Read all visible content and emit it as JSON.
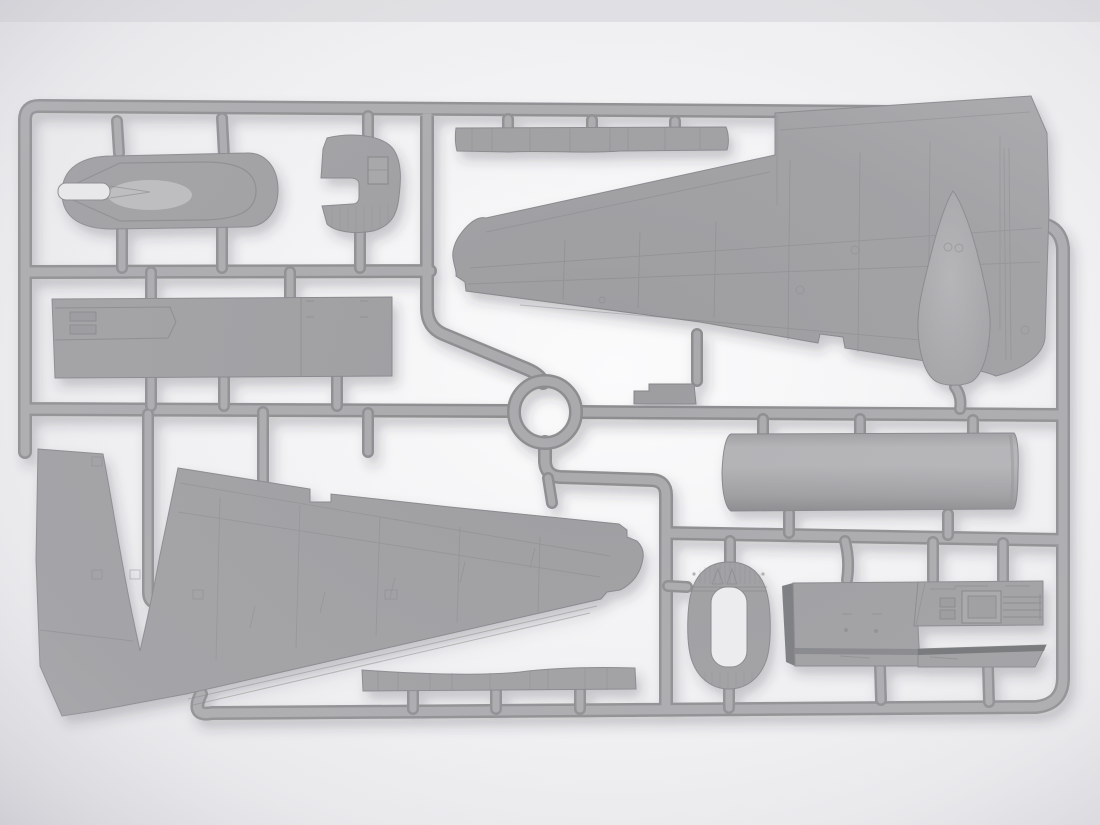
{
  "scene": {
    "subject": "gray injection-molded plastic model kit sprue photographed on a light background",
    "canvas": {
      "width": 1100,
      "height": 825
    }
  },
  "colors": {
    "bg_corner": "#e0e0e4",
    "bg_mid": "#f0f0f2",
    "bg_center": "#fbfbfc",
    "plastic": "#9d9da0",
    "plastic_light": "#b2b2b5",
    "plastic_lighter": "#c0c0c3",
    "plastic_dark": "#8a8a8d",
    "plastic_darker": "#77797b",
    "wedge_dark": "#6e7072",
    "runner_core": "#a9a9ac",
    "runner_edge": "#8c8c8f",
    "part_outline": "#85858a",
    "panel_line": "#808084",
    "slot_light": "#e9e9eb",
    "cutout_light": "#ececee",
    "shadow": "rgba(40,40,48,0.25)"
  },
  "parts": [
    {
      "id": "sprue-frame",
      "label": "outer runner frame"
    },
    {
      "id": "runner-ring",
      "label": "central circular runner ring"
    },
    {
      "id": "oval-pod",
      "label": "oval pod fairing part (top left)"
    },
    {
      "id": "hook-cowl",
      "label": "hook shaped cowl part"
    },
    {
      "id": "long-panel",
      "label": "long rectangular door panel part"
    },
    {
      "id": "upper-wing",
      "label": "large tapered wing half (upper right)"
    },
    {
      "id": "teardrop-fairing",
      "label": "teardrop fairing / tank half"
    },
    {
      "id": "step-bracket",
      "label": "small stepped bracket part"
    },
    {
      "id": "cylinder-tank",
      "label": "cylindrical tank part"
    },
    {
      "id": "lower-wing",
      "label": "large wing half with V cutout (bottom left)"
    },
    {
      "id": "upper-strip",
      "label": "narrow strip part (top)"
    },
    {
      "id": "lower-strip",
      "label": "narrow strip part (bottom)"
    },
    {
      "id": "oval-bulkhead",
      "label": "oval bulkhead with rounded cutout"
    },
    {
      "id": "cockpit-deck",
      "label": "flat cockpit deck part with molded detail"
    }
  ]
}
